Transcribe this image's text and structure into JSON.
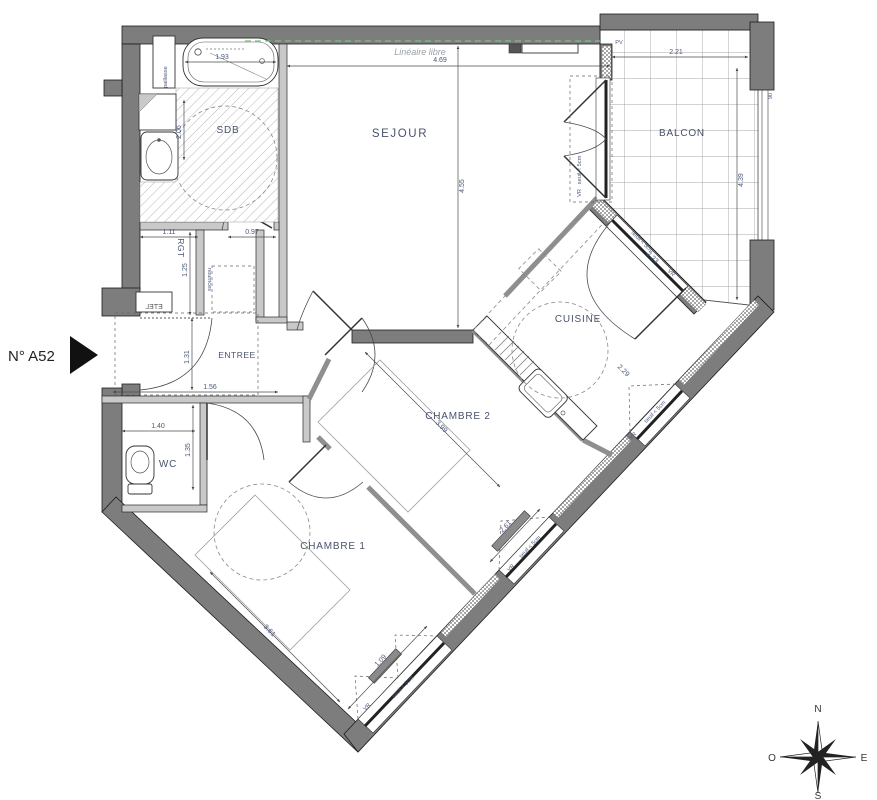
{
  "unit": {
    "number": "N° A52"
  },
  "rooms": {
    "sdb": "SDB",
    "sejour": "SEJOUR",
    "balcon": "BALCON",
    "cuisine": "CUISINE",
    "rgt": "RGT",
    "entree": "ENTREE",
    "wc": "WC",
    "chambre1": "CHAMBRE 1",
    "chambre2": "CHAMBRE 2"
  },
  "annotations": {
    "lineaire_libre": "Linéaire libre",
    "paillasse": "paillasse",
    "nourrices": "nourrices",
    "etel": "ETEL",
    "pv": "PV",
    "vr": "VR",
    "seuil": "seuil < 5cm",
    "rail_height": "90"
  },
  "dimensions": {
    "bathtub": "1.93",
    "sdb_width": "2.06",
    "sejour_width": "4.69",
    "sejour_height": "4.55",
    "balcon_width": "2.21",
    "balcon_height": "4.39",
    "rgt_width": "1.11",
    "sdb_door": "0.97",
    "rgt_height": "1.25",
    "entree_height": "1.31",
    "entree_width": "1.56",
    "wc_width": "1.40",
    "wc_height": "1.35",
    "cuisine_window": "2.23",
    "cuisine_wall": "2.29",
    "chambre2_length": "3.99",
    "chambre2_width": "2.61",
    "chambre1_length": "3.61",
    "chambre1_window": "1.09"
  },
  "compass": {
    "north": "N",
    "south": "S",
    "east": "E",
    "west": "O"
  },
  "colors": {
    "wall": "#7d7d7d",
    "background": "#ffffff",
    "dimension_text": "#49597a",
    "label_text": "#49536b",
    "lineaire_line": "#7cc47c",
    "lineaire_text": "#9aa0a6"
  }
}
